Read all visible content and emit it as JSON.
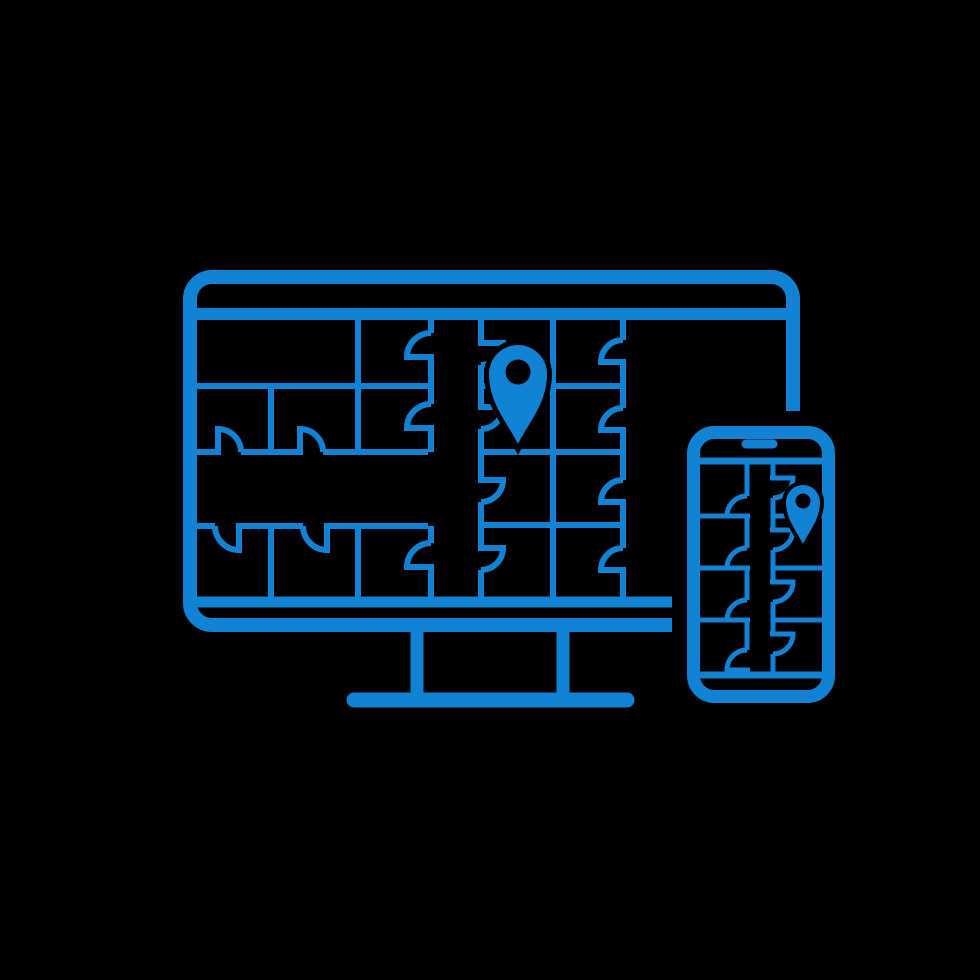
{
  "icon": {
    "title": "Responsive devices displaying a city map with location pins",
    "accent_color": "#1182d4",
    "background_color": "#000000",
    "devices": [
      {
        "name": "desktop-monitor",
        "screen_content": "city-block map with streets, driveway notches and a location pin"
      },
      {
        "name": "smartphone",
        "screen_content": "city-block map with a vertical street, driveway notches and a location pin"
      }
    ],
    "pins": {
      "count": 2,
      "style": "map-pin with hollow center"
    }
  }
}
